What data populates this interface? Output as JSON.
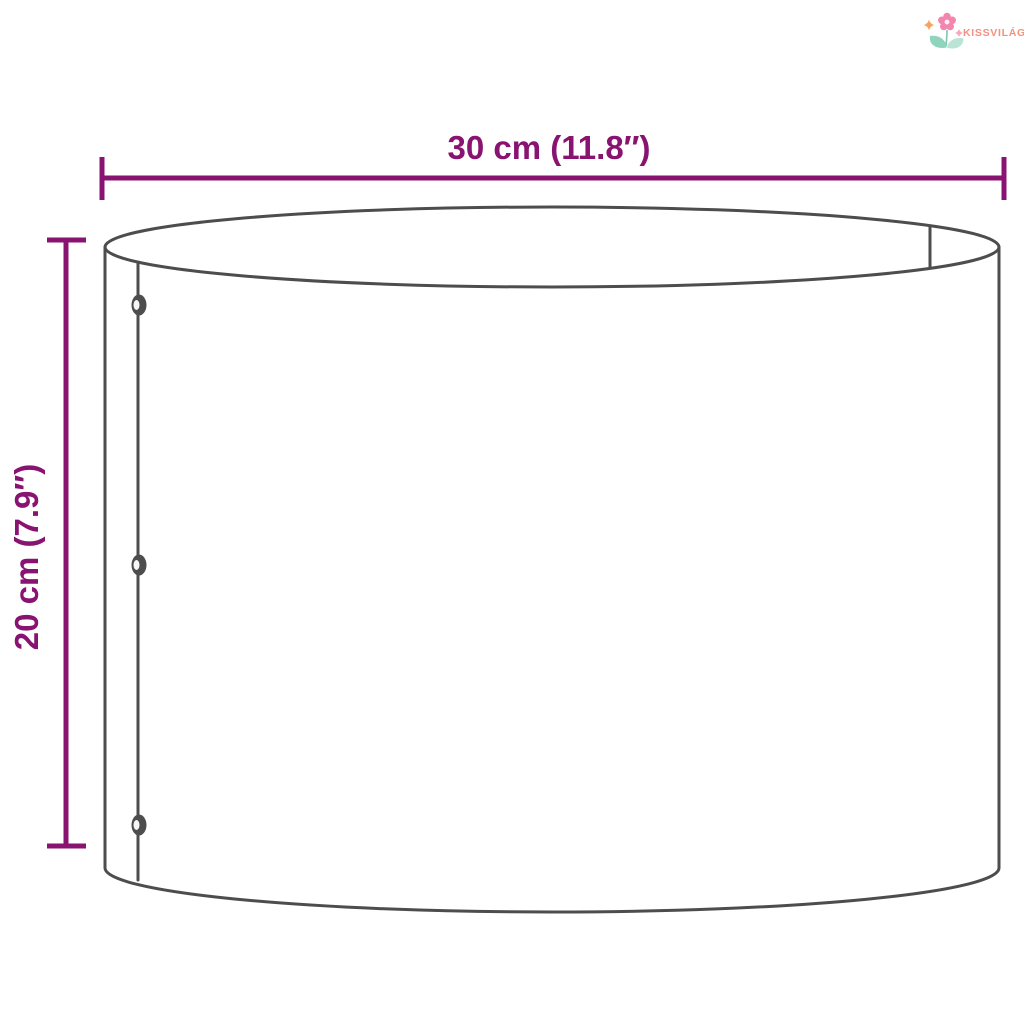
{
  "colors": {
    "background": "#ffffff",
    "dimension": "#881371",
    "outline": "#4d4d4d",
    "brand": "#F2917F",
    "flower-petal": "#F386AE",
    "leaf-dark": "#8FD4BC",
    "leaf-light": "#BAE4D5",
    "sparkle-orange": "#F6A45F",
    "sparkle-pink": "#F5A9B8"
  },
  "logo": {
    "brand": "KISSVILÁG",
    "icon": "flower-logo-icon"
  },
  "diagram": {
    "width_label": "30 cm (11.8″)",
    "height_label": "20 cm (7.9″)"
  }
}
